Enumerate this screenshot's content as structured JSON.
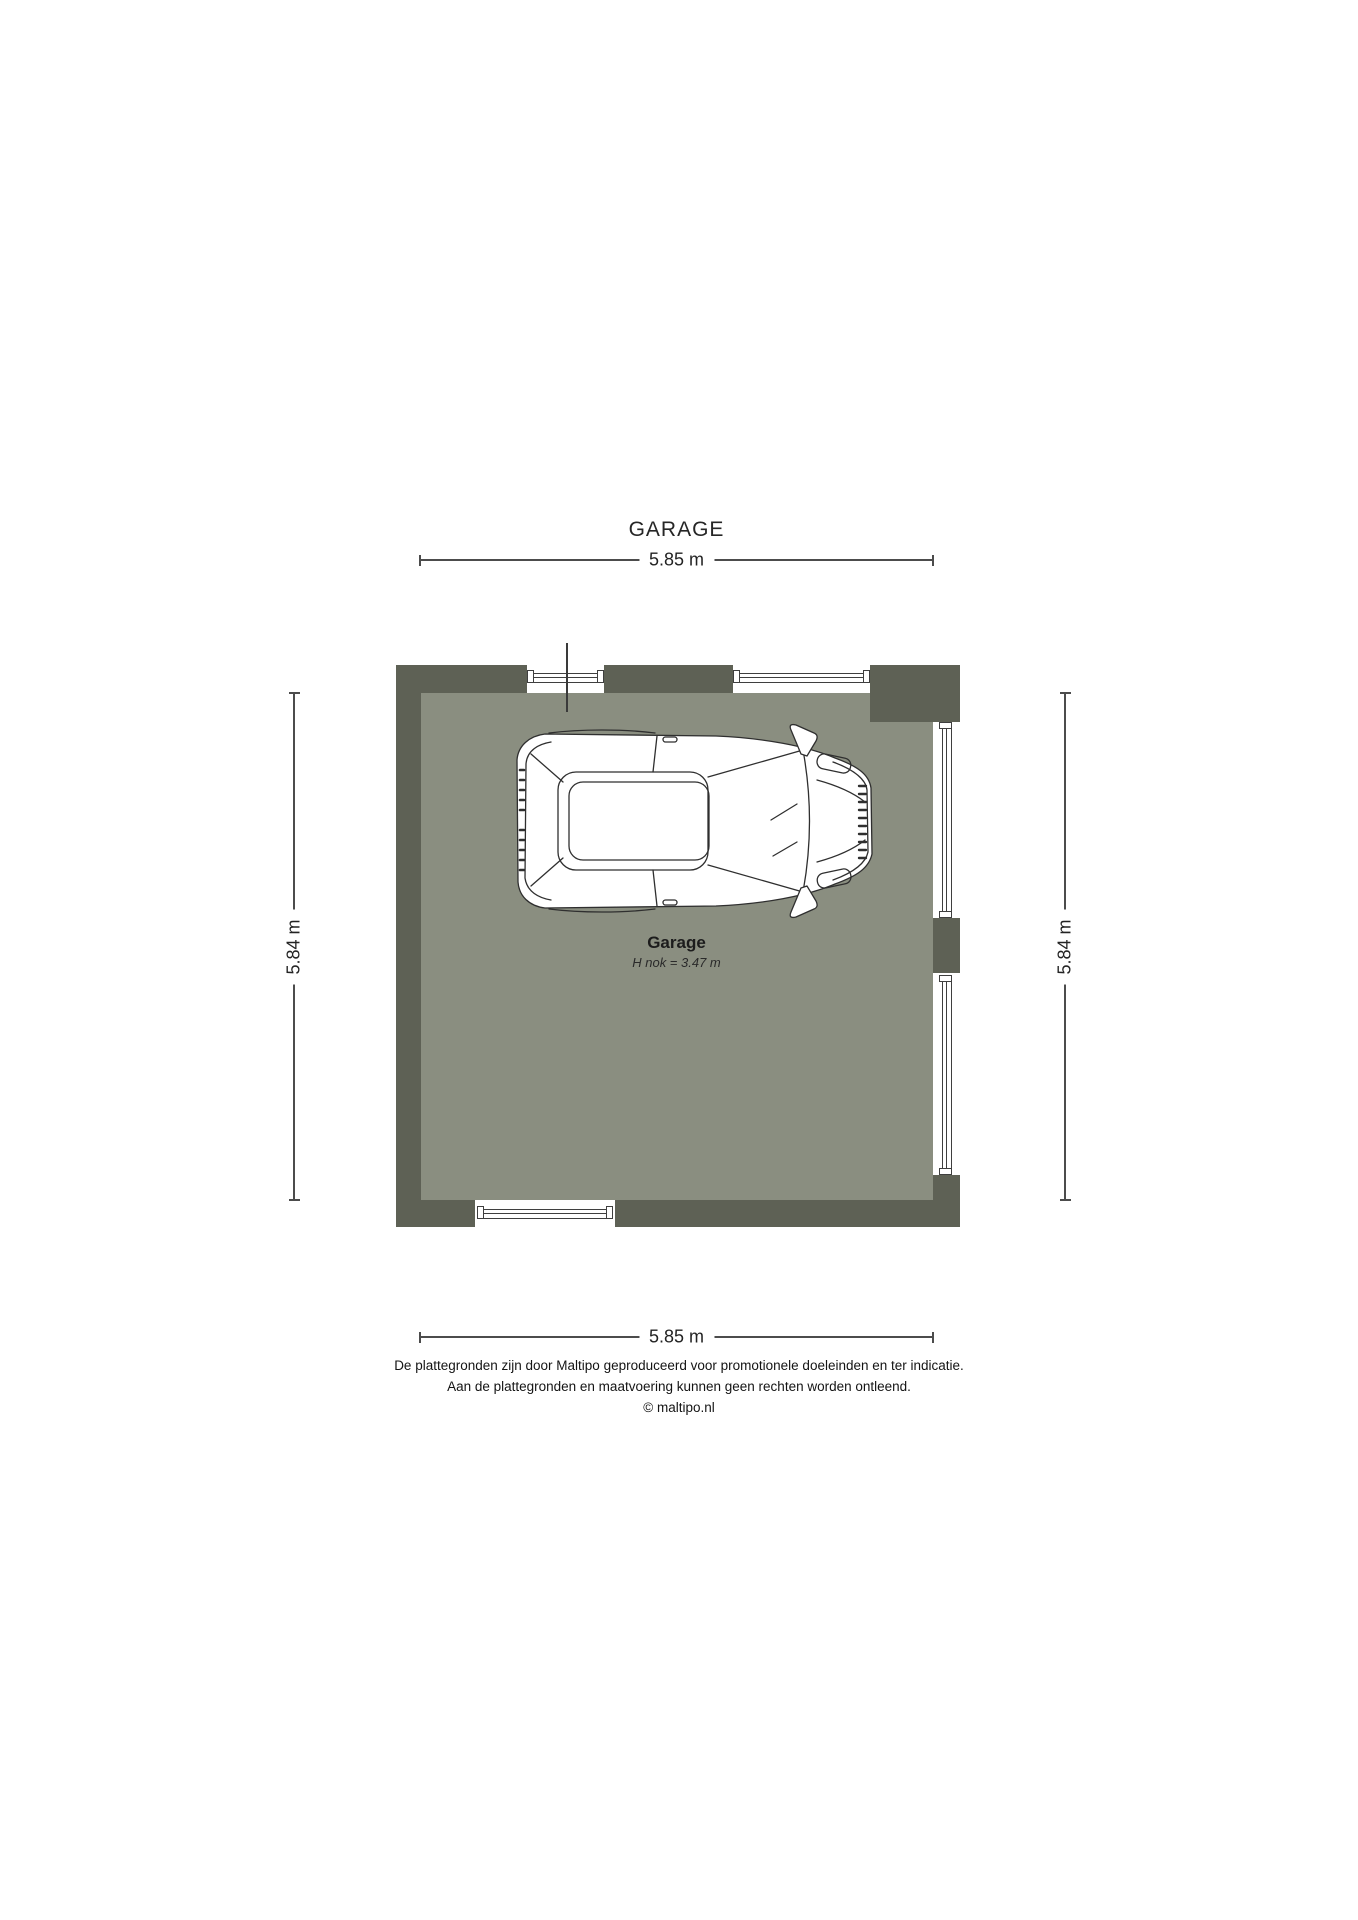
{
  "title": "GARAGE",
  "dimensions": {
    "top": "5.85 m",
    "bottom": "5.85 m",
    "left": "5.84 m",
    "right": "5.84 m"
  },
  "room": {
    "name": "Garage",
    "ridge_height": "H nok = 3.47 m"
  },
  "footer": {
    "line1": "De plattegronden zijn door Maltipo geproduceerd voor promotionele doeleinden en ter indicatie.",
    "line2": "Aan de plattegronden en maatvoering kunnen geen rechten worden ontleend.",
    "line3": "© maltipo.nl"
  },
  "colors": {
    "wall": "#5e6155",
    "floor": "#8a8e80",
    "dimline": "#4c4c4c",
    "text": "#1e1e1e",
    "outline": "#2f2f2f",
    "frame": "#3f3f3f"
  }
}
